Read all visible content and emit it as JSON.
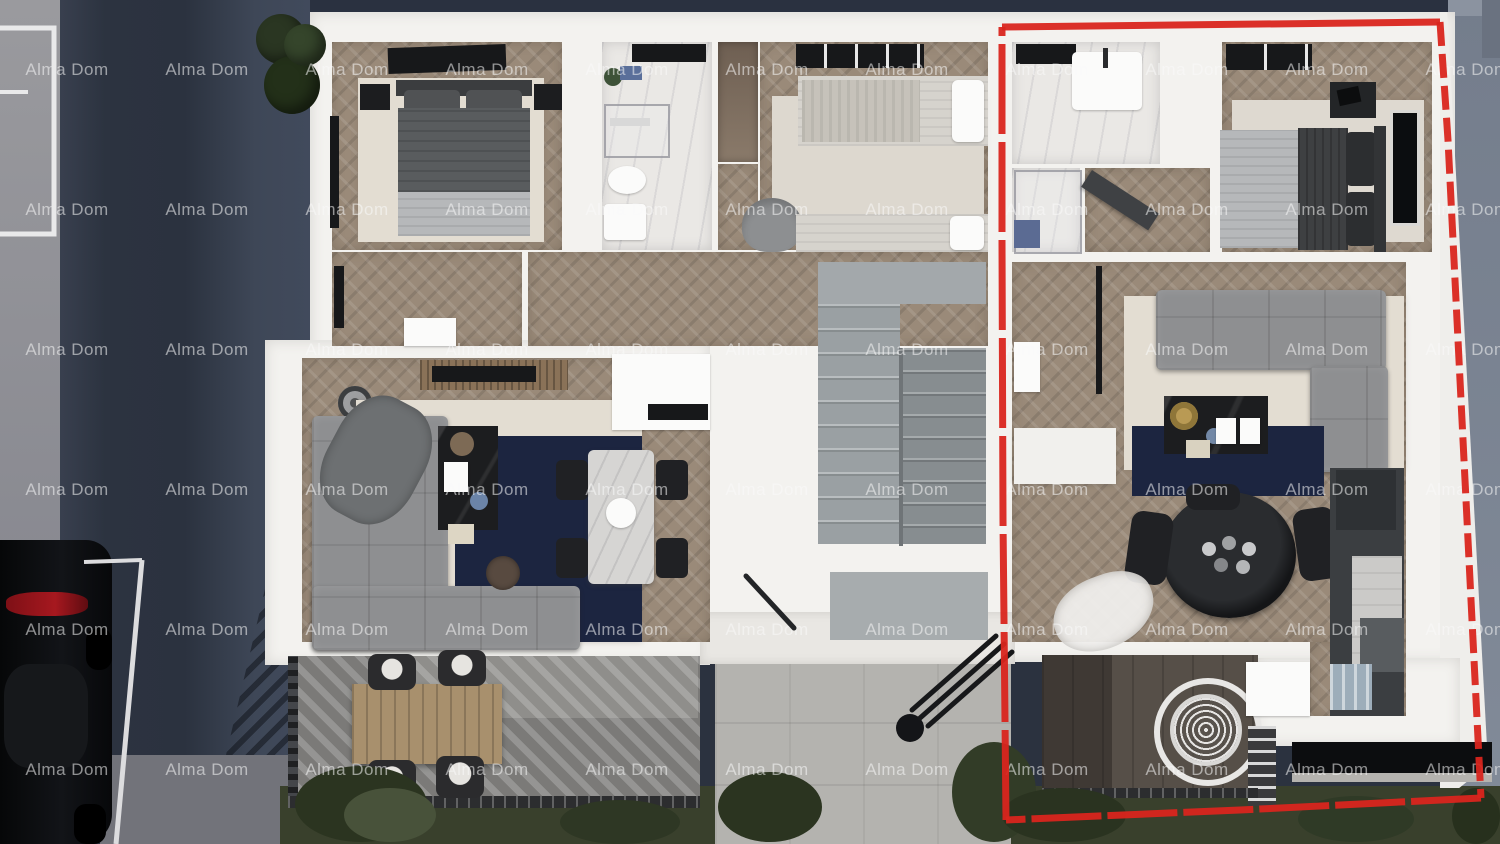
{
  "watermark": {
    "text": "Alma Dom",
    "color": "rgba(250,250,250,0.55)",
    "grid": {
      "cols": 11,
      "rows": 6,
      "origin_x": 67,
      "origin_y": 70,
      "spacing_x": 140,
      "spacing_y": 140
    }
  },
  "highlight": {
    "color": "#d9251d",
    "style": "hand-drawn dashed rectangle outlining right apartment unit"
  },
  "palette": {
    "highlight": "#d9251d",
    "wall": "#f3f2ef",
    "wood": "#9a8a79",
    "marble": "#eae8e5",
    "navy": "#1c2540",
    "rugBeige": "#e3ddd2",
    "sofa": "#8e8f91",
    "grass": "#39402c",
    "path": "#b4b3af",
    "road": "#3e4655",
    "wm": "rgba(250,250,250,0.55)"
  }
}
